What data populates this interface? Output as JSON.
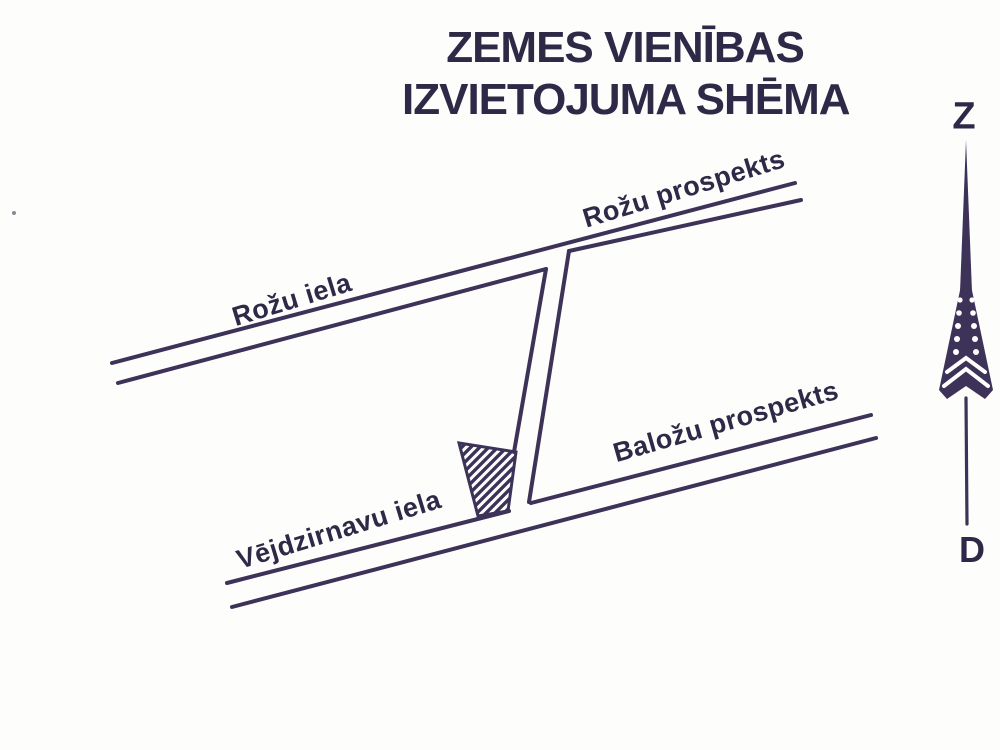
{
  "title": {
    "line1": "ZEMES VIENĪBAS",
    "line2": "IZVIETOJUMA SHĒMA"
  },
  "streets": {
    "rozu_prospekts": "Rožu prospekts",
    "rozu_iela": "Rožu iela",
    "balozu_prospekts": "Baložu prospekts",
    "vejdzirnavu_iela": "Vējdzirnavu iela"
  },
  "compass": {
    "north": "Z",
    "south": "D"
  },
  "colors": {
    "ink": "#3d3258",
    "ink_dark": "#2e2947",
    "paper": "#fdfdfb"
  }
}
